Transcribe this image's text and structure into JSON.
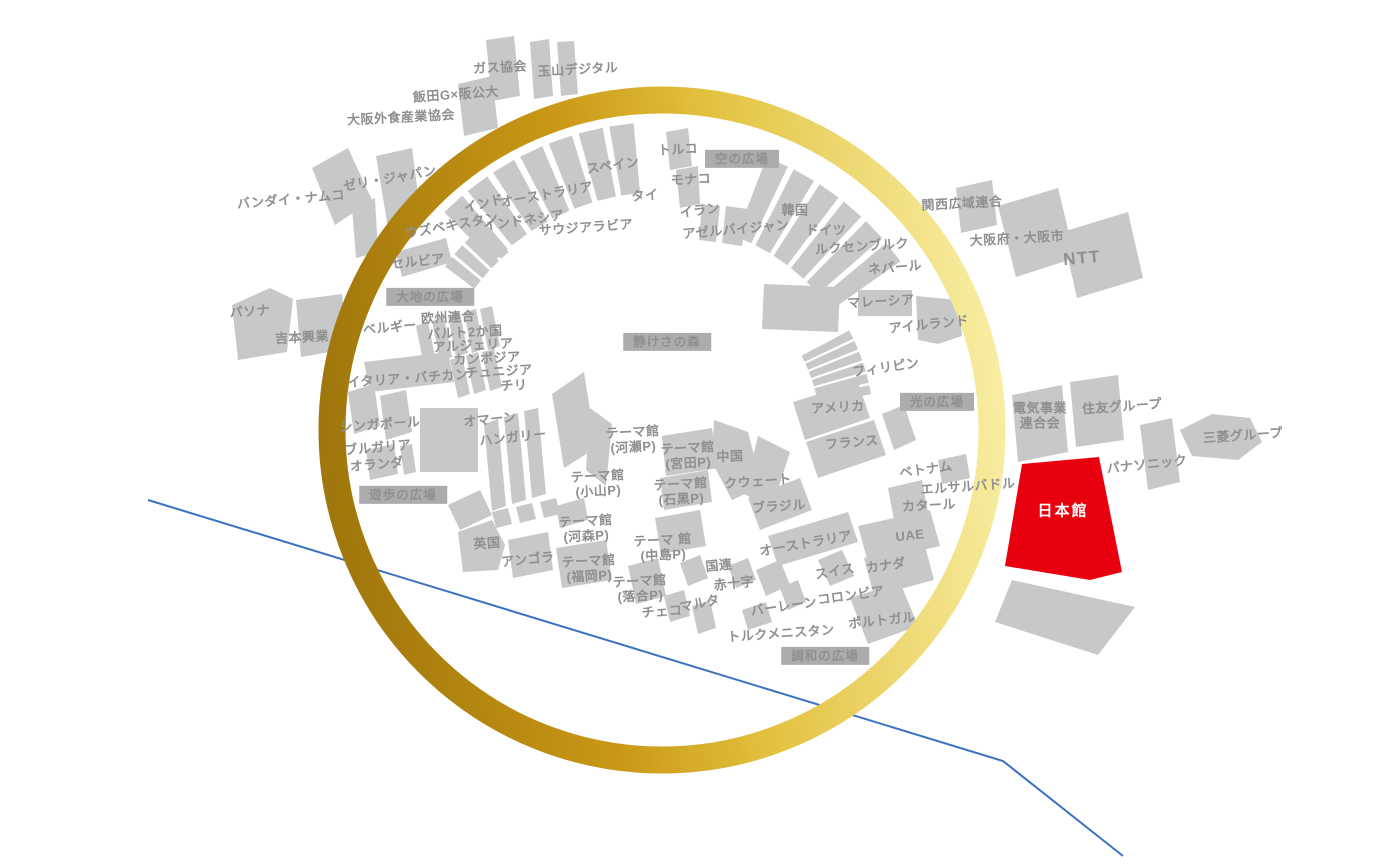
{
  "map": {
    "highlighted_pavilion": "日本館",
    "plazas": [
      "空の広場",
      "大地の広場",
      "静けさの森",
      "光の広場",
      "遊歩の広場",
      "調和の広場"
    ],
    "colors": {
      "building_gray": "#C7C8C9",
      "highlight_red": "#E8000F",
      "ring_gold_dark": "#A0770C",
      "ring_gold_mid": "#D2A019",
      "ring_gold_light": "#F7EC9F",
      "label_gray": "#8E8F91",
      "badge_bg": "#ACACAE",
      "water_line_blue": "#3A72C2"
    },
    "labels": [
      {
        "t": "ガス協会",
        "x": 500,
        "y": 68,
        "r": -3
      },
      {
        "t": "玉山デジタル",
        "x": 578,
        "y": 70,
        "r": -3
      },
      {
        "t": "飯田G×阪公大",
        "x": 456,
        "y": 95,
        "r": -4
      },
      {
        "t": "大阪外食産業協会",
        "x": 401,
        "y": 118,
        "r": -3
      },
      {
        "t": "ゼリ・ジャパン",
        "x": 390,
        "y": 179,
        "r": -10
      },
      {
        "t": "バンダイ・ナムコ",
        "x": 291,
        "y": 200,
        "r": -5
      },
      {
        "t": "インド",
        "x": 484,
        "y": 204,
        "r": -14
      },
      {
        "t": "オーストラリア",
        "x": 547,
        "y": 195,
        "r": -10
      },
      {
        "t": "ウズベキスタン",
        "x": 452,
        "y": 226,
        "r": -10
      },
      {
        "t": "インドネシア",
        "x": 524,
        "y": 221,
        "r": -8
      },
      {
        "t": "サウジアラビア",
        "x": 586,
        "y": 228,
        "r": -4
      },
      {
        "t": "スペイン",
        "x": 613,
        "y": 166,
        "r": -8
      },
      {
        "t": "タイ",
        "x": 645,
        "y": 196,
        "r": -5
      },
      {
        "t": "トルコ",
        "x": 678,
        "y": 150,
        "r": -3
      },
      {
        "t": "モナコ",
        "x": 691,
        "y": 180,
        "r": -3
      },
      {
        "t": "空の広場",
        "x": 742,
        "y": 159,
        "k": "badge"
      },
      {
        "t": "イラン",
        "x": 700,
        "y": 211,
        "r": -8
      },
      {
        "t": "アゼルバイジャン",
        "x": 736,
        "y": 230,
        "r": -5
      },
      {
        "t": "韓国",
        "x": 795,
        "y": 211
      },
      {
        "t": "ドイツ",
        "x": 826,
        "y": 231
      },
      {
        "t": "ルクセンブルク",
        "x": 862,
        "y": 247,
        "r": -4
      },
      {
        "t": "ネパール",
        "x": 895,
        "y": 268,
        "r": -5
      },
      {
        "t": "関西広域連合",
        "x": 962,
        "y": 204,
        "r": -3
      },
      {
        "t": "大阪府・大阪市",
        "x": 1017,
        "y": 239,
        "r": -3
      },
      {
        "t": "NTT",
        "x": 1082,
        "y": 258,
        "r": -5,
        "k": "big"
      },
      {
        "t": "セルビア",
        "x": 418,
        "y": 262,
        "r": -6
      },
      {
        "t": "大地の広場",
        "x": 430,
        "y": 297,
        "k": "badge"
      },
      {
        "t": "パソナ",
        "x": 250,
        "y": 312,
        "r": -4
      },
      {
        "t": "ベルギー",
        "x": 390,
        "y": 328,
        "r": -5
      },
      {
        "t": "欧州連合",
        "x": 448,
        "y": 318,
        "r": -3
      },
      {
        "t": "バルト2か国",
        "x": 465,
        "y": 333,
        "r": -3
      },
      {
        "t": "アルジェリア",
        "x": 473,
        "y": 346,
        "r": -3
      },
      {
        "t": "吉本興業",
        "x": 302,
        "y": 338,
        "r": -3
      },
      {
        "t": "カンボジア",
        "x": 487,
        "y": 359,
        "r": -3
      },
      {
        "t": "チュニジア",
        "x": 499,
        "y": 372,
        "r": -3
      },
      {
        "t": "イタリア・バチカン",
        "x": 408,
        "y": 379,
        "r": -4
      },
      {
        "t": "チリ",
        "x": 514,
        "y": 386,
        "r": -3
      },
      {
        "t": "マレーシア",
        "x": 881,
        "y": 302,
        "r": -3
      },
      {
        "t": "アイルランド",
        "x": 929,
        "y": 325,
        "r": -6
      },
      {
        "t": "静けさの森",
        "x": 667,
        "y": 342,
        "k": "badge"
      },
      {
        "t": "フィリピン",
        "x": 886,
        "y": 368,
        "r": -8
      },
      {
        "t": "光の広場",
        "x": 937,
        "y": 402,
        "k": "badge"
      },
      {
        "t": "アメリカ",
        "x": 838,
        "y": 408,
        "r": -3
      },
      {
        "t": "フランス",
        "x": 852,
        "y": 443,
        "r": -5
      },
      {
        "t": "シンガポール",
        "x": 380,
        "y": 425,
        "r": -4
      },
      {
        "t": "オマーン",
        "x": 490,
        "y": 420,
        "r": -6
      },
      {
        "t": "ハンガリー",
        "x": 513,
        "y": 438,
        "r": -6
      },
      {
        "t": "ブルガリア",
        "x": 378,
        "y": 448,
        "r": -5
      },
      {
        "t": "オランダ",
        "x": 377,
        "y": 465,
        "r": -5
      },
      {
        "t": "テーマ館\n(河瀬P)",
        "x": 633,
        "y": 440,
        "r": -3
      },
      {
        "t": "テーマ館\n(宮田P)",
        "x": 688,
        "y": 456,
        "r": -3
      },
      {
        "t": "中国",
        "x": 730,
        "y": 457,
        "r": -2
      },
      {
        "t": "テーマ館\n(小山P)",
        "x": 598,
        "y": 484,
        "r": -3
      },
      {
        "t": "クウェート",
        "x": 758,
        "y": 482,
        "r": -4
      },
      {
        "t": "テーマ館\n(石黒P)",
        "x": 681,
        "y": 492,
        "r": -3
      },
      {
        "t": "ブラジル",
        "x": 779,
        "y": 507,
        "r": -4
      },
      {
        "t": "遊歩の広場",
        "x": 403,
        "y": 495,
        "k": "badge"
      },
      {
        "t": "テーマ館\n(河森P)",
        "x": 586,
        "y": 529,
        "r": -3
      },
      {
        "t": "英国",
        "x": 487,
        "y": 544,
        "r": -4
      },
      {
        "t": "アンゴラ",
        "x": 528,
        "y": 560,
        "r": -6
      },
      {
        "t": "テーマ館\n(福岡P)",
        "x": 589,
        "y": 569,
        "r": -3
      },
      {
        "t": "テーマ 館\n(中島P)",
        "x": 663,
        "y": 548,
        "r": -3
      },
      {
        "t": "国連",
        "x": 719,
        "y": 566,
        "r": -6
      },
      {
        "t": "赤十字",
        "x": 734,
        "y": 584,
        "r": -6
      },
      {
        "t": "テーマ館\n(落合P)",
        "x": 640,
        "y": 589,
        "r": -3
      },
      {
        "t": "マルタ",
        "x": 700,
        "y": 604,
        "r": -12
      },
      {
        "t": "チェコ",
        "x": 662,
        "y": 612,
        "r": -4
      },
      {
        "t": "バーレーン",
        "x": 784,
        "y": 607,
        "r": -8
      },
      {
        "t": "トルクメニスタン",
        "x": 781,
        "y": 634,
        "r": -4
      },
      {
        "t": "調和の広場",
        "x": 825,
        "y": 656,
        "k": "badge"
      },
      {
        "t": "オーストラリア",
        "x": 806,
        "y": 544,
        "r": -10
      },
      {
        "t": "スイス",
        "x": 835,
        "y": 572,
        "r": -10
      },
      {
        "t": "カナダ",
        "x": 886,
        "y": 566,
        "r": -8
      },
      {
        "t": "UAE",
        "x": 910,
        "y": 536,
        "r": -6
      },
      {
        "t": "コロンビア",
        "x": 851,
        "y": 596,
        "r": -8
      },
      {
        "t": "ポルトガル",
        "x": 882,
        "y": 621,
        "r": -6
      },
      {
        "t": "カタール",
        "x": 929,
        "y": 506,
        "r": -3
      },
      {
        "t": "エルサルバドル",
        "x": 968,
        "y": 487,
        "r": -4
      },
      {
        "t": "ベトナム",
        "x": 926,
        "y": 470,
        "r": -8
      },
      {
        "t": "電気事業\n連合会",
        "x": 1040,
        "y": 416
      },
      {
        "t": "住友グループ",
        "x": 1122,
        "y": 407,
        "r": -4
      },
      {
        "t": "パナソニック",
        "x": 1147,
        "y": 465,
        "r": -6
      },
      {
        "t": "三菱グループ",
        "x": 1243,
        "y": 436,
        "r": -4
      },
      {
        "t": "日本館",
        "x": 1063,
        "y": 512,
        "k": "jp"
      }
    ]
  }
}
